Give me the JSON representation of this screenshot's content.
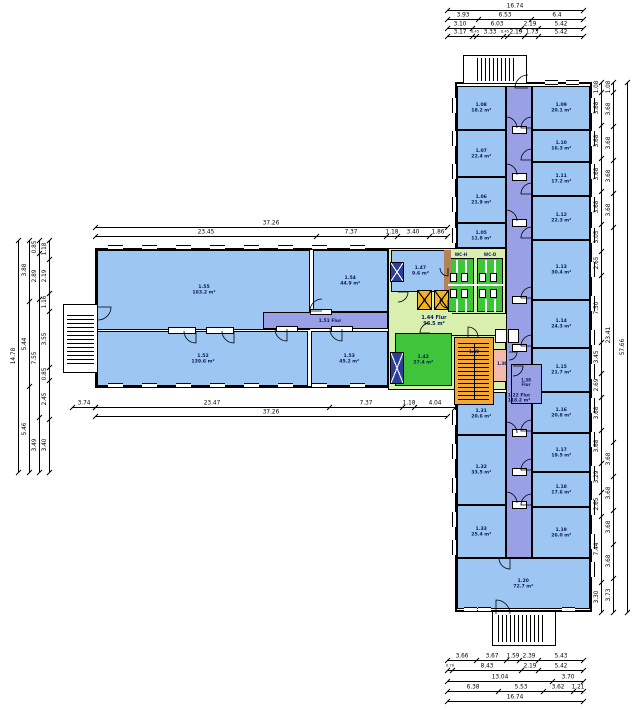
{
  "drawing": {
    "type": "architectural-floor-plan",
    "units": "m"
  },
  "colors": {
    "room_blue": "#9dc6f2",
    "corridor_purple": "#9aa0e6",
    "hall_green": "#d8efad",
    "wc_green": "#3fc53a",
    "stair_orange": "#f0a73c",
    "elevator_yellow": "#f3b51f",
    "pink": "#f3b9ac",
    "shaft_navy": "#2b3f99",
    "brown": "#b5835a",
    "wall": "#000000",
    "label": "#0a1a5c"
  },
  "outlines": [
    [
      95,
      248,
      295,
      140
    ],
    [
      455,
      82,
      137,
      530
    ]
  ],
  "rooms": [
    [
      "hall",
      388,
      248,
      118,
      142,
      ""
    ],
    [
      "blue",
      97,
      250,
      213,
      80,
      "1.55\n163.2 m²"
    ],
    [
      "blue",
      313,
      250,
      75,
      62,
      "1.54\n44.9 m²"
    ],
    [
      "blue",
      97,
      331,
      211,
      55,
      "1.52\n139.6 m²"
    ],
    [
      "blue",
      311,
      331,
      77,
      55,
      "1.53\n45.2 m²"
    ],
    [
      "blue",
      457,
      86,
      49,
      44,
      "1.08\n18.2 m²"
    ],
    [
      "blue",
      457,
      130,
      49,
      47,
      "1.07\n22.4 m²"
    ],
    [
      "blue",
      457,
      177,
      49,
      46,
      "1.06\n21.9 m²"
    ],
    [
      "blue",
      457,
      223,
      49,
      25,
      "1.05\n11.8 m²"
    ],
    [
      "blue",
      457,
      392,
      49,
      43,
      "1.31\n20.6 m²"
    ],
    [
      "blue",
      457,
      435,
      49,
      70,
      "1.32\n33.5 m²"
    ],
    [
      "blue",
      457,
      505,
      49,
      53,
      "1.33\n25.4 m²"
    ],
    [
      "blue",
      532,
      86,
      58,
      44,
      "1.09\n20.1 m²"
    ],
    [
      "blue",
      532,
      130,
      58,
      32,
      "1.10\n16.3 m²"
    ],
    [
      "blue",
      532,
      162,
      58,
      34,
      "1.11\n17.2 m²"
    ],
    [
      "blue",
      532,
      196,
      58,
      44,
      "1.12\n22.3 m²"
    ],
    [
      "blue",
      532,
      240,
      58,
      60,
      "1.13\n30.4 m²"
    ],
    [
      "blue",
      532,
      300,
      58,
      48,
      "1.14\n24.3 m²"
    ],
    [
      "blue",
      532,
      348,
      58,
      44,
      "1.15\n21.7 m²"
    ],
    [
      "blue",
      532,
      392,
      58,
      41,
      "1.16\n20.8 m²"
    ],
    [
      "blue",
      532,
      433,
      58,
      39,
      "1.17\n19.5 m²"
    ],
    [
      "blue",
      532,
      472,
      58,
      35,
      "1.18\n17.6 m²"
    ],
    [
      "blue",
      532,
      507,
      58,
      51,
      "1.19\n26.0 m²"
    ],
    [
      "blue",
      457,
      558,
      133,
      51,
      "1.20\n72.7 m²"
    ],
    [
      "blue",
      391,
      250,
      58,
      42,
      "1.47\n9.6 m²"
    ],
    [
      "wc",
      448,
      258,
      26,
      54,
      ""
    ],
    [
      "wc",
      477,
      258,
      26,
      54,
      ""
    ],
    [
      "green",
      395,
      333,
      57,
      53,
      "1.42\n27.4 m²"
    ],
    [
      "pink",
      493,
      349,
      18,
      33,
      ""
    ],
    [
      "orange",
      454,
      337,
      40,
      68,
      ""
    ]
  ],
  "corridors": [
    [
      "corr",
      506,
      86,
      26,
      472,
      ""
    ],
    [
      "corr",
      263,
      312,
      125,
      17,
      ""
    ],
    [
      "corr",
      511,
      364,
      31,
      40,
      ""
    ]
  ],
  "hall_extension": [
    452,
    313,
    56,
    23
  ],
  "plain_rects": [
    [
      444,
      250,
      7,
      42,
      "brown"
    ],
    [
      458,
      368,
      31,
      6,
      "orange"
    ],
    [
      493,
      58,
      8,
      23,
      "#ffffff"
    ],
    [
      518,
      615,
      8,
      27,
      "#ffffff"
    ],
    [
      67,
      335,
      27,
      8,
      "#ffffff"
    ]
  ],
  "x_shafts": [
    [
      390,
      262,
      14,
      20,
      "navy",
      "#ffffff"
    ],
    [
      390,
      352,
      14,
      32,
      "navy",
      "#ffffff"
    ],
    [
      417,
      290,
      15,
      20,
      "elev",
      "#000000"
    ],
    [
      434,
      290,
      15,
      20,
      "elev",
      "#000000"
    ]
  ],
  "ext_stair_boxes": [
    [
      463,
      55,
      64,
      29
    ],
    [
      492,
      611,
      64,
      35
    ],
    [
      63,
      304,
      35,
      69
    ]
  ],
  "stairs_hatch": [
    [
      477,
      58,
      40,
      23,
      "v"
    ],
    [
      498,
      615,
      46,
      27,
      "v"
    ],
    [
      67,
      313,
      27,
      51,
      "h"
    ],
    [
      458,
      343,
      31,
      57,
      "h"
    ]
  ],
  "lines": [
    [
      448,
      284,
      55,
      "h",
      "#ffffff",
      2
    ],
    [
      456,
      260,
      13,
      "v",
      "#ffffff",
      1.5
    ],
    [
      465,
      260,
      13,
      "v",
      "#ffffff",
      1.5
    ],
    [
      485,
      260,
      13,
      "v",
      "#ffffff",
      1.5
    ],
    [
      494,
      260,
      13,
      "v",
      "#ffffff",
      1.5
    ],
    [
      456,
      299,
      13,
      "v",
      "#ffffff",
      1.5
    ],
    [
      465,
      299,
      13,
      "v",
      "#ffffff",
      1.5
    ],
    [
      485,
      299,
      13,
      "v",
      "#ffffff",
      1.5
    ],
    [
      494,
      299,
      13,
      "v",
      "#ffffff",
      1.5
    ],
    [
      474,
      343,
      57,
      "v",
      "#000000",
      1
    ]
  ],
  "white_boxes": [
    [
      450,
      273,
      7,
      9
    ],
    [
      461,
      273,
      7,
      9
    ],
    [
      479,
      273,
      7,
      9
    ],
    [
      490,
      273,
      7,
      9
    ],
    [
      450,
      289,
      7,
      9
    ],
    [
      461,
      289,
      7,
      9
    ],
    [
      479,
      289,
      7,
      9
    ],
    [
      490,
      289,
      7,
      9
    ],
    [
      495,
      329,
      12,
      14
    ],
    [
      508,
      329,
      11,
      14
    ],
    [
      168,
      327,
      28,
      7
    ],
    [
      206,
      327,
      28,
      7
    ],
    [
      276,
      326,
      22,
      6
    ],
    [
      331,
      326,
      22,
      6
    ],
    [
      310,
      309,
      22,
      6
    ],
    [
      512,
      126,
      15,
      8
    ],
    [
      512,
      173,
      15,
      8
    ],
    [
      512,
      219,
      15,
      8
    ],
    [
      512,
      296,
      15,
      8
    ],
    [
      512,
      344,
      15,
      8
    ],
    [
      512,
      429,
      15,
      8
    ],
    [
      512,
      468,
      15,
      8
    ],
    [
      512,
      501,
      15,
      8
    ]
  ],
  "windows": [
    [
      "h",
      108,
      245,
      15
    ],
    [
      "h",
      142,
      245,
      15
    ],
    [
      "h",
      176,
      245,
      15
    ],
    [
      "h",
      210,
      245,
      15
    ],
    [
      "h",
      244,
      245,
      15
    ],
    [
      "h",
      278,
      245,
      15
    ],
    [
      "h",
      312,
      245,
      15
    ],
    [
      "h",
      350,
      245,
      15
    ],
    [
      "h",
      108,
      383,
      15
    ],
    [
      "h",
      142,
      383,
      15
    ],
    [
      "h",
      176,
      383,
      15
    ],
    [
      "h",
      210,
      383,
      15
    ],
    [
      "h",
      244,
      383,
      15
    ],
    [
      "h",
      278,
      383,
      15
    ],
    [
      "h",
      312,
      383,
      15
    ],
    [
      "h",
      350,
      383,
      15
    ],
    [
      "h",
      545,
      80,
      13
    ],
    [
      "h",
      566,
      80,
      13
    ],
    [
      "h",
      464,
      607,
      13
    ],
    [
      "h",
      478,
      607,
      13
    ],
    [
      "h",
      562,
      607,
      13
    ],
    [
      "v",
      452,
      98,
      15
    ],
    [
      "v",
      452,
      131,
      15
    ],
    [
      "v",
      452,
      164,
      15
    ],
    [
      "v",
      452,
      197,
      15
    ],
    [
      "v",
      452,
      228,
      15
    ],
    [
      "v",
      452,
      410,
      15
    ],
    [
      "v",
      452,
      444,
      15
    ],
    [
      "v",
      452,
      478,
      15
    ],
    [
      "v",
      452,
      512,
      15
    ],
    [
      "v",
      452,
      540,
      15
    ],
    [
      "v",
      590,
      98,
      15
    ],
    [
      "v",
      590,
      131,
      15
    ],
    [
      "v",
      590,
      164,
      15
    ],
    [
      "v",
      590,
      197,
      15
    ],
    [
      "v",
      590,
      228,
      15
    ],
    [
      "v",
      590,
      262,
      15
    ],
    [
      "v",
      590,
      296,
      15
    ],
    [
      "v",
      590,
      330,
      15
    ],
    [
      "v",
      590,
      364,
      15
    ],
    [
      "v",
      590,
      398,
      15
    ],
    [
      "v",
      590,
      432,
      15
    ],
    [
      "v",
      590,
      466,
      15
    ],
    [
      "v",
      590,
      500,
      15
    ],
    [
      "v",
      590,
      534,
      15
    ],
    [
      "v",
      590,
      562,
      15
    ]
  ],
  "doors": [
    [
      506,
      128,
      11,
      270
    ],
    [
      506,
      175,
      11,
      270
    ],
    [
      506,
      221,
      11,
      270
    ],
    [
      506,
      433,
      11,
      270
    ],
    [
      506,
      503,
      11,
      270
    ],
    [
      532,
      128,
      11,
      180
    ],
    [
      532,
      160,
      11,
      180
    ],
    [
      532,
      194,
      11,
      180
    ],
    [
      532,
      238,
      11,
      180
    ],
    [
      532,
      298,
      11,
      180
    ],
    [
      532,
      346,
      11,
      180
    ],
    [
      532,
      431,
      11,
      180
    ],
    [
      532,
      470,
      11,
      180
    ],
    [
      532,
      505,
      11,
      180
    ],
    [
      510,
      558,
      11,
      90
    ],
    [
      322,
      311,
      12,
      180
    ],
    [
      287,
      329,
      12,
      90
    ],
    [
      342,
      329,
      12,
      90
    ],
    [
      196,
      331,
      12,
      90
    ],
    [
      234,
      331,
      12,
      90
    ],
    [
      98,
      307,
      13,
      0
    ],
    [
      398,
      292,
      10,
      0
    ],
    [
      430,
      333,
      10,
      180
    ],
    [
      468,
      337,
      10,
      270
    ],
    [
      448,
      268,
      8,
      90
    ],
    [
      448,
      300,
      8,
      90
    ],
    [
      528,
      88,
      13,
      180
    ],
    [
      496,
      614,
      14,
      270
    ],
    [
      513,
      366,
      10,
      0
    ],
    [
      509,
      352,
      8,
      0
    ]
  ],
  "labels": [
    [
      330,
      320.5,
      "1.51 Flur",
      4.5,
      0
    ],
    [
      519,
      398,
      "1.22 Flur\n118.2 m²",
      4.5,
      0
    ],
    [
      434,
      321,
      "1.44 Flur\n96.5 m²",
      5,
      0
    ],
    [
      461,
      255,
      "WC-H",
      4,
      0
    ],
    [
      490,
      255,
      "WC-D",
      4,
      0
    ],
    [
      502,
      364,
      "1.39",
      4,
      0
    ],
    [
      526,
      383,
      "1.38\nFlur",
      4,
      0
    ],
    [
      474,
      352,
      "1.40",
      4,
      0
    ]
  ],
  "dim_chains": [
    {
      "o": "h",
      "y": 10,
      "a": 447,
      "b": 583,
      "v": [
        "16.74"
      ]
    },
    {
      "o": "h",
      "y": 19,
      "a": 447,
      "b": 583,
      "v": [
        "3.93",
        "6.53",
        "6.4"
      ]
    },
    {
      "o": "h",
      "y": 28,
      "a": 447,
      "b": 583,
      "v": [
        "3.10",
        "6.03",
        "2.19",
        "5.42"
      ]
    },
    {
      "o": "h",
      "y": 36,
      "a": 447,
      "b": 583,
      "v": [
        "3.17",
        "0.45",
        "3.33",
        "0.45",
        "2.19",
        "1.73",
        "5.42"
      ]
    },
    {
      "o": "h",
      "y": 227,
      "a": 95,
      "b": 447,
      "v": [
        "37.26"
      ]
    },
    {
      "o": "h",
      "y": 236,
      "a": 95,
      "b": 447,
      "v": [
        "23.45",
        "7.37",
        "1.18",
        "3.40",
        "1.86"
      ]
    },
    {
      "o": "h",
      "y": 407,
      "a": 72,
      "b": 95,
      "v": [
        "3.74"
      ]
    },
    {
      "o": "h",
      "y": 407,
      "a": 95,
      "b": 455,
      "v": [
        "23.47",
        "7.37",
        "1.18",
        "4.04"
      ]
    },
    {
      "o": "h",
      "y": 416,
      "a": 95,
      "b": 447,
      "v": [
        "37.26"
      ]
    },
    {
      "o": "h",
      "y": 660,
      "a": 447,
      "b": 583,
      "v": [
        "3.66",
        "3.67",
        "1.59",
        "2.39",
        "5.43"
      ]
    },
    {
      "o": "h",
      "y": 670,
      "a": 447,
      "b": 583,
      "v": [
        "0.70",
        "8.43",
        "2.19",
        "5.42"
      ]
    },
    {
      "o": "h",
      "y": 681,
      "a": 447,
      "b": 583,
      "v": [
        "13.04",
        "3.70"
      ]
    },
    {
      "o": "h",
      "y": 691,
      "a": 447,
      "b": 583,
      "v": [
        "6.38",
        "5.53",
        "3.62",
        "1.21"
      ]
    },
    {
      "o": "h",
      "y": 701,
      "a": 447,
      "b": 583,
      "v": [
        "16.74"
      ]
    },
    {
      "o": "v",
      "x": 18,
      "a": 240,
      "b": 472,
      "v": [
        "14.78"
      ]
    },
    {
      "o": "v",
      "x": 29,
      "a": 240,
      "b": 472,
      "v": [
        "3.88",
        "5.44",
        "5.46"
      ]
    },
    {
      "o": "v",
      "x": 39,
      "a": 240,
      "b": 472,
      "v": [
        "0.85",
        "2.89",
        "7.55",
        "3.49"
      ]
    },
    {
      "o": "v",
      "x": 49,
      "a": 240,
      "b": 472,
      "v": [
        "1.18",
        "2.19",
        "1.16",
        "3.55",
        "0.85",
        "2.45",
        "3.40"
      ]
    },
    {
      "o": "v",
      "x": 601,
      "a": 82,
      "b": 612,
      "v": [
        "1.08",
        "3.68",
        "3.68",
        "3.68",
        "3.68",
        "3.05",
        "2.65",
        "7.50",
        "3.45",
        "2.69",
        "3.68",
        "3.68",
        "3.29",
        "2.65",
        "7.44",
        "3.30"
      ]
    },
    {
      "o": "v",
      "x": 613,
      "a": 82,
      "b": 612,
      "v": [
        "1.08",
        "3.68",
        "3.68",
        "3.68",
        "3.68",
        "23.41",
        "3.68",
        "3.68",
        "3.68",
        "3.68",
        "3.73"
      ]
    },
    {
      "o": "v",
      "x": 627,
      "a": 82,
      "b": 612,
      "v": [
        "57.66"
      ]
    }
  ]
}
